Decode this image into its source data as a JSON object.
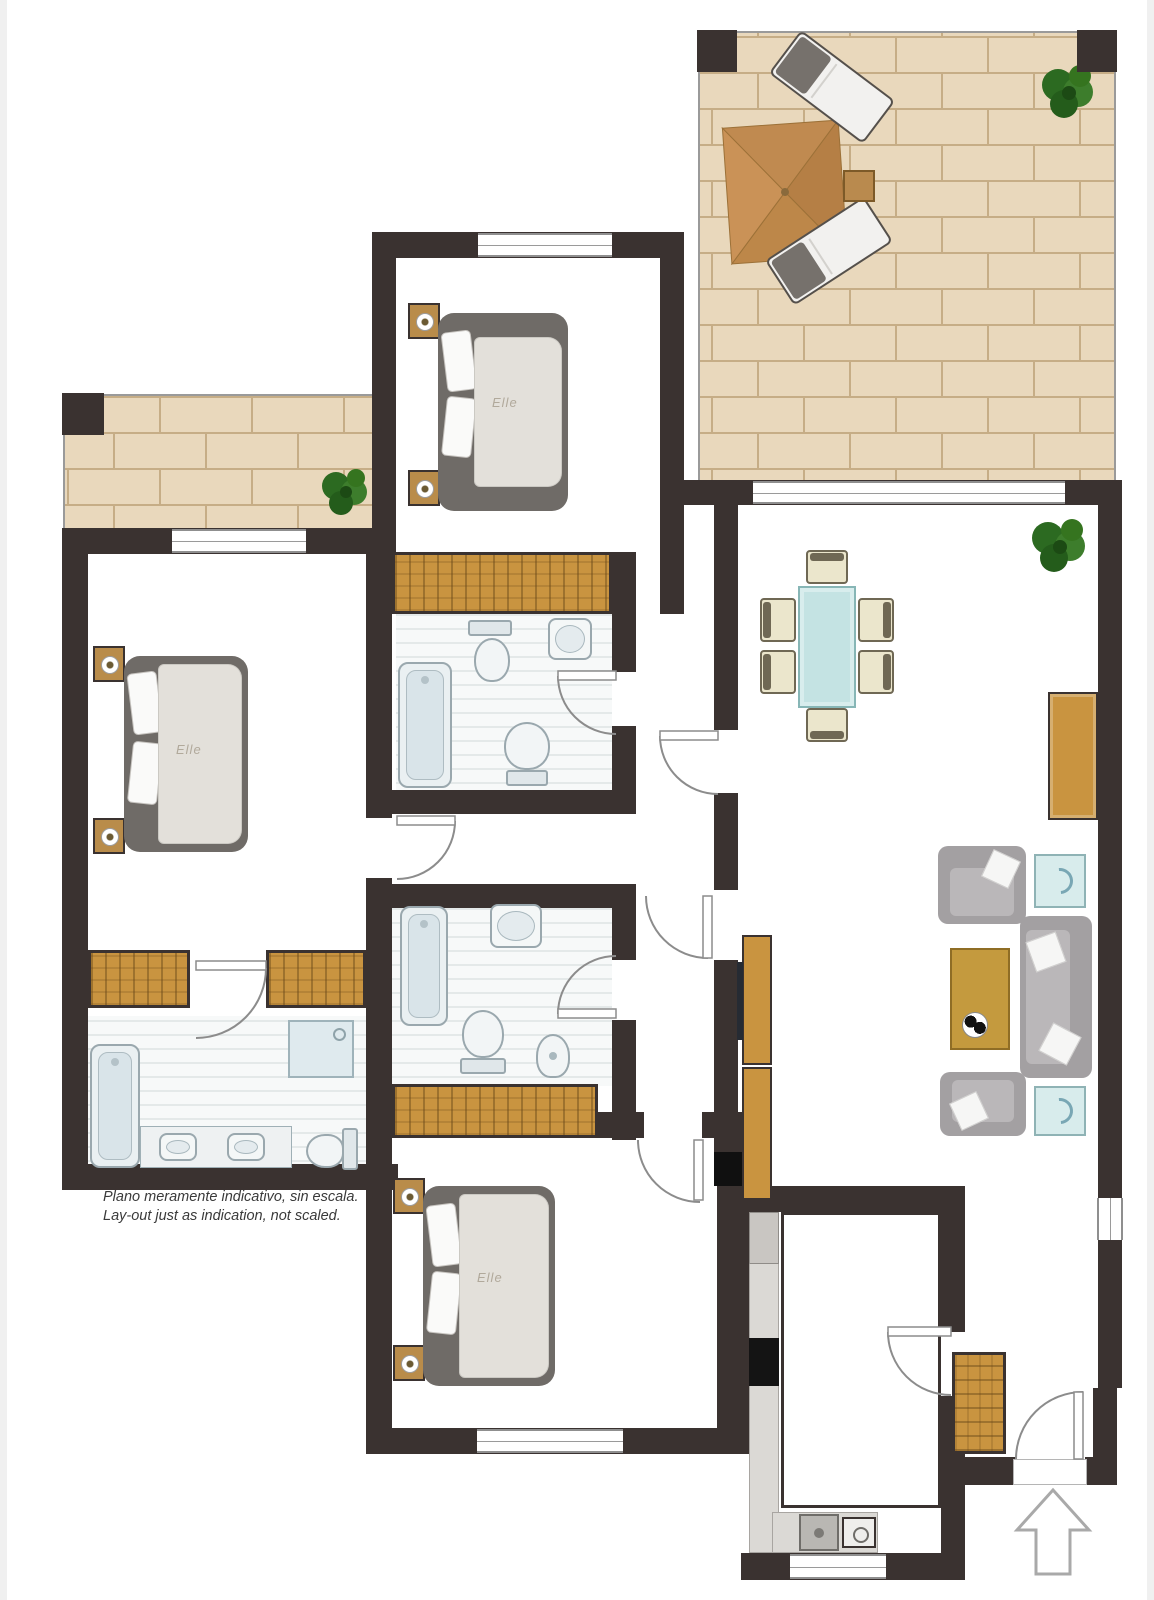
{
  "disclaimer": {
    "line1": "Plano meramente indicativo, sin escala.",
    "line2": "Lay-out just as indication, not scaled."
  },
  "bed_brand": "Elle",
  "icons": {
    "entrance_arrow": "up-arrow-outline",
    "door_swings": "quarter-circle-arc",
    "plants": "green-shrub-top-view",
    "parasol": "square-parasol-top-view"
  },
  "colors": {
    "wall": "#3a3230",
    "wood": "#c99440",
    "brick": "#e9d8bc",
    "brickline": "#c6ad86",
    "sofagray": "#a3a0a2",
    "tableblue": "#c4e3e3",
    "plantgreen": "#2f6d24",
    "arrowgray": "#a9a9a9",
    "fixture": "#eaf0f2",
    "stripe": "#e8ecec"
  }
}
